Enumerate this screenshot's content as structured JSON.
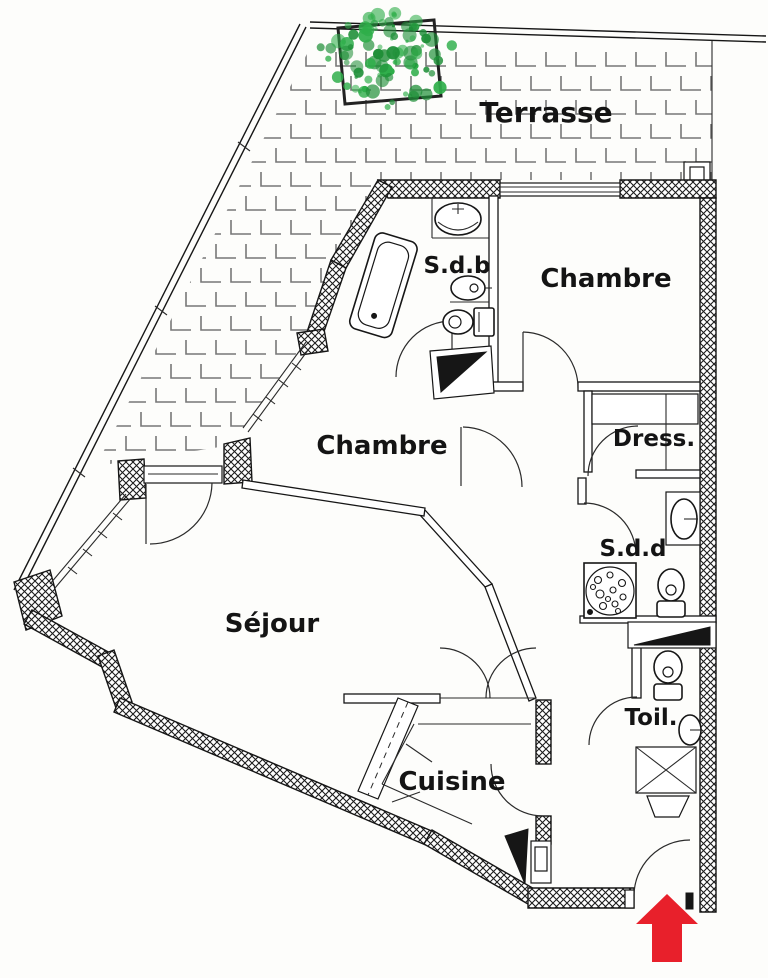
{
  "plan": {
    "type": "apartment-floor-plan",
    "labels": {
      "terrasse": "Terrasse",
      "sdb": "S.d.b",
      "chambre_top": "Chambre",
      "chambre_mid": "Chambre",
      "dress": "Dress.",
      "sdd": "S.d.d",
      "sejour": "Séjour",
      "toil": "Toil.",
      "cuisine": "Cuisine"
    },
    "colors": {
      "line": "#161616",
      "wall_hatch": "#1c1c1c",
      "tile": "#777777",
      "plant_green": "#2fae4a",
      "plant_green_dark": "#1f8f38",
      "entrance_arrow_red": "#e8202b",
      "background": "#fdfdfb"
    },
    "icons": {
      "entrance_arrow": "up-arrow"
    }
  }
}
